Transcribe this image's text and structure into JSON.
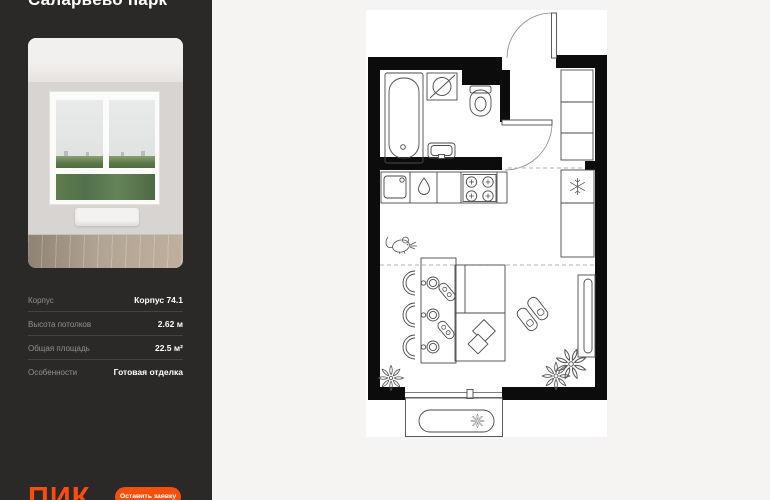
{
  "app": {
    "background": "#f5f4f2"
  },
  "sidebar": {
    "background": "#2b2928",
    "accent": "#fb4c0d",
    "title": "Саларьево парк",
    "photo": {
      "description": "empty room, white window with view of green trees, radiator, wood floor"
    },
    "specs": [
      {
        "label": "Корпус",
        "value": "Корпус 74.1"
      },
      {
        "label": "Высота потолков",
        "value": "2.62 м"
      },
      {
        "label": "Общая площадь",
        "value": "22.5 м²"
      },
      {
        "label": "Особенности",
        "value": "Готовая отделка"
      }
    ],
    "logo_text": "ПИК",
    "cta_label": "Оставить заявку"
  },
  "floorplan": {
    "sheet_color": "#ffffff",
    "wall_color": "#0c0c0c",
    "fixtures": [
      "entrance-door",
      "bathroom-door",
      "bathtub",
      "washing-machine",
      "toilet",
      "bathroom-sink",
      "kitchen-counter",
      "kitchen-sink",
      "water-drop",
      "stove",
      "hall-wardrobe",
      "refrigerator",
      "cabinet-column",
      "dining-table",
      "chairs",
      "plates",
      "cutlery-mats",
      "bed",
      "wall-mirror",
      "slippers-doodle",
      "mouse-doodle",
      "plants",
      "balcony",
      "balcony-bench",
      "bench-flower"
    ]
  }
}
